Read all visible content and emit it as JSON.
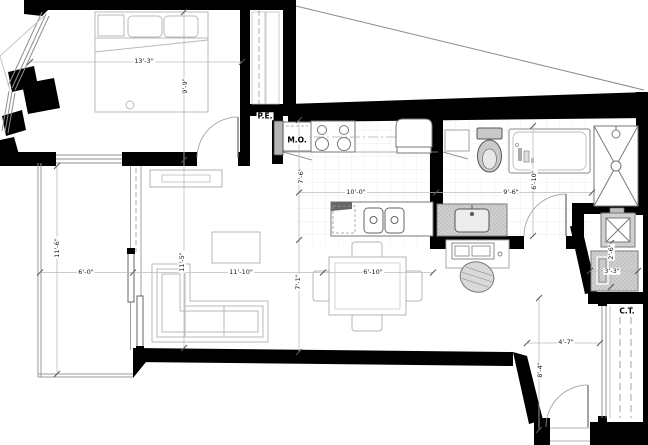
{
  "plan_labels": {
    "bedroom": {
      "width": "13'-3\"",
      "depth": "9'-9\""
    },
    "living": {
      "width": "11'-10\"",
      "depth": "11'-5\"",
      "clearance": "7'-1\""
    },
    "dining": {
      "width": "6'-10\""
    },
    "kitchen": {
      "width": "10'-0\"",
      "depth": "7'-6\""
    },
    "bathroom": {
      "width": "9'-6\"",
      "depth": "6'-10\""
    },
    "balcony": {
      "width": "6'-0\"",
      "depth": "11'-6\""
    },
    "laundry": {
      "width": "3'-3\"",
      "depth": "2'-6\""
    },
    "entry": {
      "width": "4'-7\"",
      "depth": "8'-4\""
    },
    "tags": {
      "electrical_panel": "P.E.",
      "microwave": "M.O.",
      "coat_closet": "C.T."
    }
  },
  "colors": {
    "wall": "#000000",
    "furniture_line": "#b9b9b9",
    "fixture_line": "#6f6f6f",
    "dimension_line": "#bcbcbc",
    "grid": "#e6e6e6",
    "text": "#1a1a1a",
    "fill_gray": "#cfcfcf"
  }
}
